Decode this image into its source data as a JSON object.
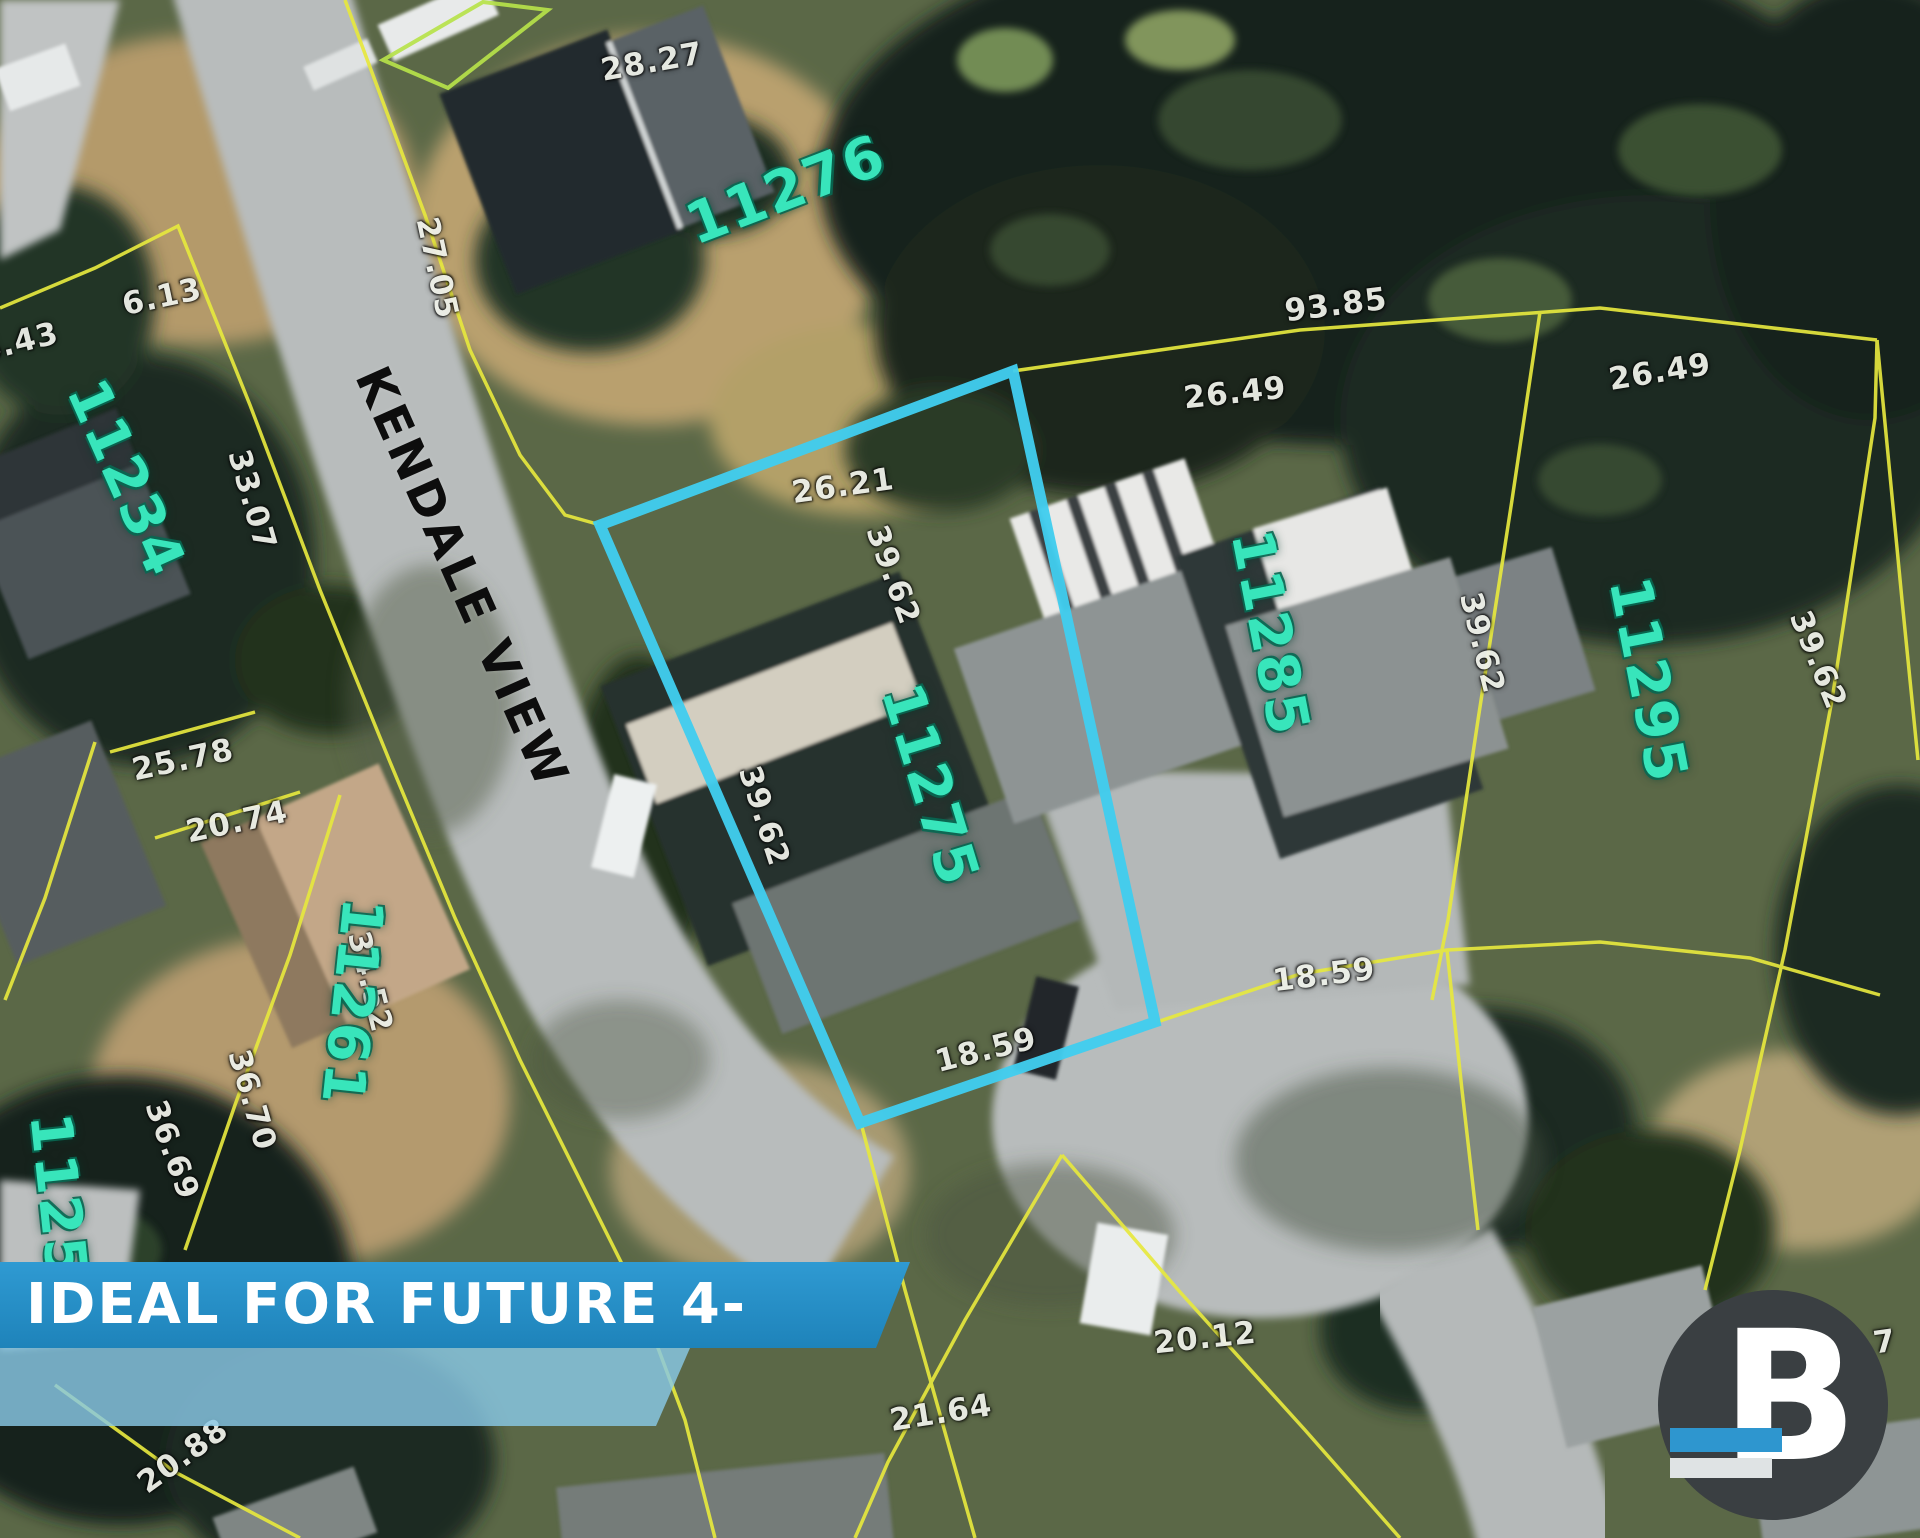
{
  "banner": {
    "text": "IDEAL FOR FUTURE 4-PLEX"
  },
  "street": {
    "name": "KENDALE VIEW"
  },
  "highlighted_lot": {
    "number": "11275",
    "front_dimension": "26.21",
    "side_dimensions": [
      "39.62",
      "39.62"
    ],
    "rear_dimension": "18.59",
    "outline_color": "#41cdee"
  },
  "logo": {
    "letter": "B"
  },
  "colors": {
    "lot_number_text": "#38e5bb",
    "dimension_text": "#eef0e8",
    "parcel_line_yellow": "#e6e83e",
    "highlight_cyan": "#41cdee",
    "banner_blue": "#2590c9",
    "banner_light_blue": "#89c8e5"
  },
  "labels": [
    {
      "name": "dim-28-27",
      "cls": "dim",
      "text": "28.27",
      "x": 652,
      "y": 62,
      "rot": -10
    },
    {
      "name": "dim-27-05",
      "cls": "dim",
      "text": "27.05",
      "x": 437,
      "y": 268,
      "rot": 78
    },
    {
      "name": "dim-6-13",
      "cls": "dim",
      "text": "6.13",
      "x": 162,
      "y": 297,
      "rot": -12
    },
    {
      "name": "dim-26-43-partial",
      "cls": "dim",
      "text": "26.43",
      "x": 8,
      "y": 345,
      "rot": -14
    },
    {
      "name": "dim-33-07",
      "cls": "dim",
      "text": "33.07",
      "x": 252,
      "y": 500,
      "rot": 74
    },
    {
      "name": "dim-26-21",
      "cls": "dim",
      "text": "26.21",
      "x": 843,
      "y": 486,
      "rot": -8
    },
    {
      "name": "dim-26-49-a",
      "cls": "dim",
      "text": "26.49",
      "x": 1235,
      "y": 393,
      "rot": -6
    },
    {
      "name": "dim-93-85",
      "cls": "dim",
      "text": "93.85",
      "x": 1336,
      "y": 305,
      "rot": -7
    },
    {
      "name": "dim-26-49-b",
      "cls": "dim",
      "text": "26.49",
      "x": 1660,
      "y": 372,
      "rot": -9
    },
    {
      "name": "dim-39-62-west",
      "cls": "dim",
      "text": "39.62",
      "x": 764,
      "y": 816,
      "rot": 72
    },
    {
      "name": "dim-39-62-east",
      "cls": "dim",
      "text": "39.62",
      "x": 893,
      "y": 575,
      "rot": 70
    },
    {
      "name": "dim-39-62-c",
      "cls": "dim",
      "text": "39.62",
      "x": 1482,
      "y": 643,
      "rot": 76
    },
    {
      "name": "dim-39-62-d",
      "cls": "dim",
      "text": "39.62",
      "x": 1818,
      "y": 660,
      "rot": 68
    },
    {
      "name": "dim-18-59-inner",
      "cls": "dim",
      "text": "18.59",
      "x": 986,
      "y": 1050,
      "rot": -14
    },
    {
      "name": "dim-18-59-outer",
      "cls": "dim",
      "text": "18.59",
      "x": 1324,
      "y": 975,
      "rot": -7
    },
    {
      "name": "dim-25-78",
      "cls": "dim",
      "text": "25.78",
      "x": 183,
      "y": 760,
      "rot": -12
    },
    {
      "name": "dim-20-74",
      "cls": "dim",
      "text": "20.74",
      "x": 237,
      "y": 822,
      "rot": -12
    },
    {
      "name": "dim-34-52",
      "cls": "dim",
      "text": "34.52",
      "x": 370,
      "y": 982,
      "rot": 76
    },
    {
      "name": "dim-36-70",
      "cls": "dim",
      "text": "36.70",
      "x": 252,
      "y": 1100,
      "rot": 74
    },
    {
      "name": "dim-36-69",
      "cls": "dim",
      "text": "36.69",
      "x": 172,
      "y": 1150,
      "rot": 70
    },
    {
      "name": "dim-20-12",
      "cls": "dim",
      "text": "20.12",
      "x": 1205,
      "y": 1338,
      "rot": -6
    },
    {
      "name": "dim-21-64",
      "cls": "dim",
      "text": "21.64",
      "x": 941,
      "y": 1413,
      "rot": -9
    },
    {
      "name": "dim-20-88",
      "cls": "dim",
      "text": "20.88",
      "x": 183,
      "y": 1456,
      "rot": -36
    },
    {
      "name": "dim-20-7-partial",
      "cls": "dim",
      "text": "20.7",
      "x": 1856,
      "y": 1346,
      "rot": -8
    },
    {
      "name": "lot-number-11276",
      "cls": "lotnum",
      "text": "11276",
      "x": 786,
      "y": 190,
      "rot": -21
    },
    {
      "name": "lot-number-11234",
      "cls": "lotnum",
      "text": "11234",
      "x": 126,
      "y": 478,
      "rot": 66
    },
    {
      "name": "lot-number-11275",
      "cls": "lotnum",
      "text": "11275",
      "x": 930,
      "y": 785,
      "rot": 73
    },
    {
      "name": "lot-number-11285",
      "cls": "lotnum",
      "text": "11285",
      "x": 1270,
      "y": 633,
      "rot": 79
    },
    {
      "name": "lot-number-11295",
      "cls": "lotnum",
      "text": "11295",
      "x": 1648,
      "y": 680,
      "rot": 79
    },
    {
      "name": "lot-number-11261",
      "cls": "lotnum",
      "text": "11261",
      "x": 352,
      "y": 1002,
      "rot": 96
    },
    {
      "name": "lot-number-1125-partial",
      "cls": "lotnum",
      "text": "1125",
      "x": 58,
      "y": 1196,
      "rot": 84
    },
    {
      "name": "street-name-label",
      "cls": "street",
      "text": "KENDALE VIEW",
      "x": 462,
      "y": 578,
      "rot": 66
    }
  ]
}
